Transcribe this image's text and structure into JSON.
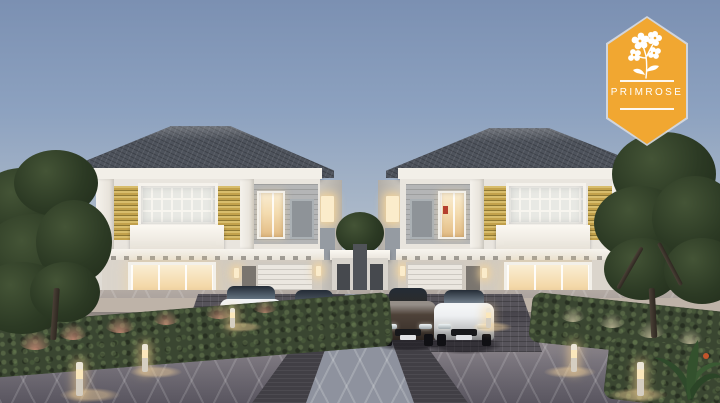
{
  "badge": {
    "label": "PRIMROSE",
    "shape": "hexagon",
    "icon": "primrose-flower-icon"
  },
  "colors": {
    "badge_bg": "#F1A731",
    "badge_border": "#D9DCE0",
    "badge_text": "#FFFFFF",
    "sky_top": "#7B90B2",
    "sky_mid": "#A9B7C8",
    "sky_horizon": "#E4DDD3",
    "roof_tile": "#4E535C",
    "fascia": "#F2EFE8",
    "wall_upper": "#E9E5DE",
    "wall_lower": "#D2CBC1",
    "accent_slat_yellow": "#C2A14B",
    "panel_gray": "#B4B5B6",
    "hedge_green": "#3A4631",
    "tree_green": "#2C3A24",
    "pad_dark": "#56535A",
    "paver_strip": "#413F45",
    "window_glow": "#F6DFB4",
    "bollard_glow": "#F5D9A8"
  },
  "cars": [
    {
      "name": "white-suv",
      "body": "#E9EBEE",
      "glass": "#8FA3B5"
    },
    {
      "name": "black-sedan",
      "body": "#1B1C20",
      "glass": "#6A7480"
    },
    {
      "name": "dark-hatchback",
      "body": "#4E4239",
      "glass": "#2E2B28"
    },
    {
      "name": "white-sedan",
      "body": "#EDEFF1",
      "glass": "#9AA9B8"
    }
  ]
}
